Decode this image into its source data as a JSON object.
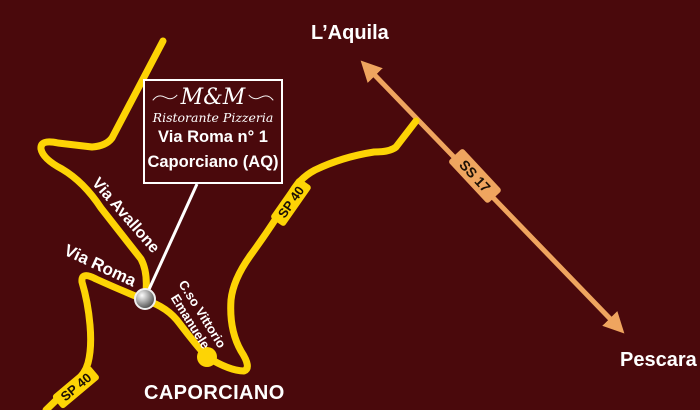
{
  "map": {
    "title_box": {
      "logo": "M&M",
      "subtitle": "Ristorante Pizzeria",
      "address_line1": "Via Roma n° 1",
      "address_line2": "Caporciano (AQ)"
    },
    "destinations": {
      "north": "L’Aquila",
      "south": "Pescara"
    },
    "town": "CAPORCIANO",
    "road_labels": {
      "via_avallone": "Via Avallone",
      "via_roma": "Via Roma",
      "corso_line1": "C.so Vittorio",
      "corso_line2": "Emanuele",
      "sp40": "SP 40",
      "ss17": "SS 17"
    },
    "colors": {
      "background": "#4a090c",
      "road_yellow": "#fdd405",
      "highway_orange": "#efa55f",
      "text_white": "#ffffff",
      "plate_text": "#1c1005"
    }
  }
}
